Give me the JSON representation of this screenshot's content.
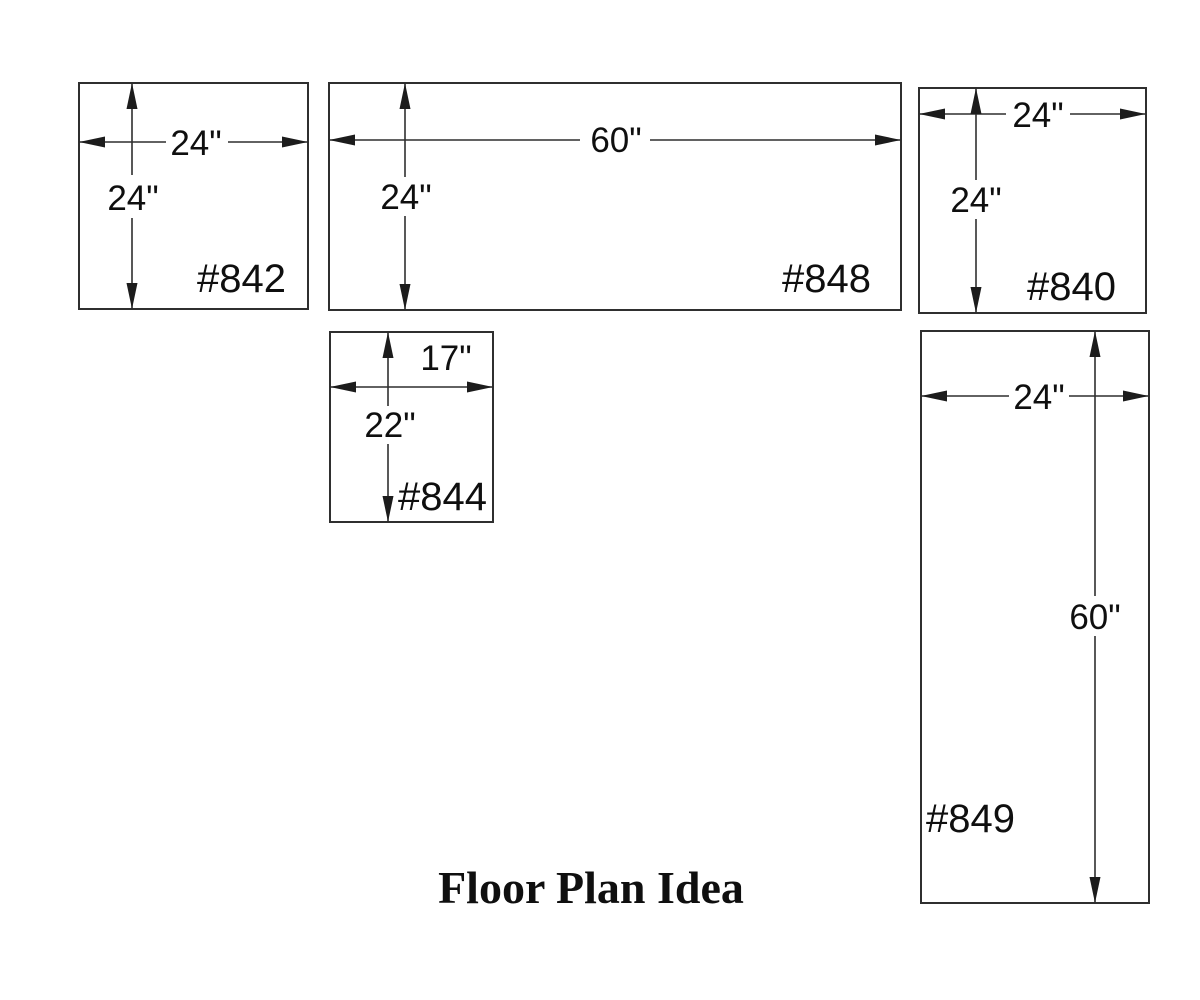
{
  "title": "Floor Plan Idea",
  "colors": {
    "line": "#2f2f2f",
    "text": "#0f0f0f",
    "background": "#ffffff"
  },
  "units": [
    {
      "id": "#842",
      "width_label": "24\"",
      "height_label": "24\"",
      "width_in": 24,
      "height_in": 24
    },
    {
      "id": "#848",
      "width_label": "60\"",
      "height_label": "24\"",
      "width_in": 60,
      "height_in": 24
    },
    {
      "id": "#840",
      "width_label": "24\"",
      "height_label": "24\"",
      "width_in": 24,
      "height_in": 24
    },
    {
      "id": "#844",
      "width_label": "17\"",
      "height_label": "22\"",
      "width_in": 17,
      "height_in": 22
    },
    {
      "id": "#849",
      "width_label": "24\"",
      "height_label": "60\"",
      "width_in": 24,
      "height_in": 60
    }
  ]
}
